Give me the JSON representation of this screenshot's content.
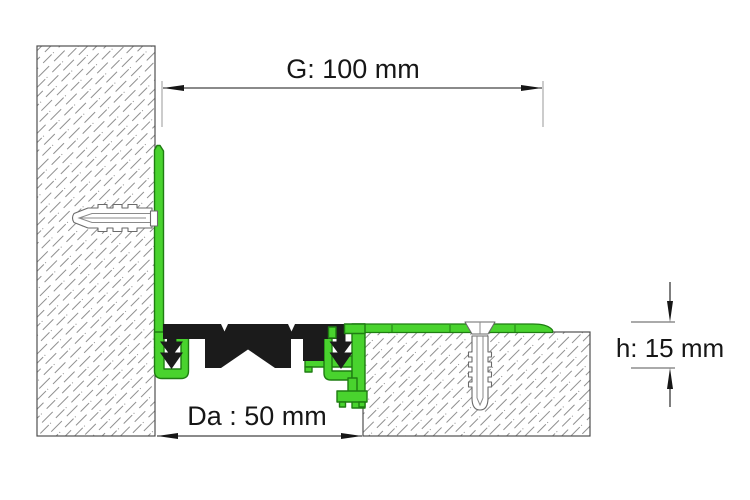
{
  "drawing": {
    "type": "technical-cross-section",
    "subject": "expansion joint profile between wall and floor slab"
  },
  "labels": {
    "gap_width": "G: 100 mm",
    "joint_width": "Da : 50 mm",
    "profile_height": "h: 15 mm"
  },
  "colors": {
    "profile_green_fill": "#49d32e",
    "profile_green_stroke": "#1f7d12",
    "rubber_insert_black": "#1b1b1b",
    "hatch_gray": "#8f8f8f",
    "outline_gray": "#4f4f4f",
    "dimension_black": "#161616",
    "extension_gray": "#9a9a9a",
    "background": "#ffffff"
  }
}
